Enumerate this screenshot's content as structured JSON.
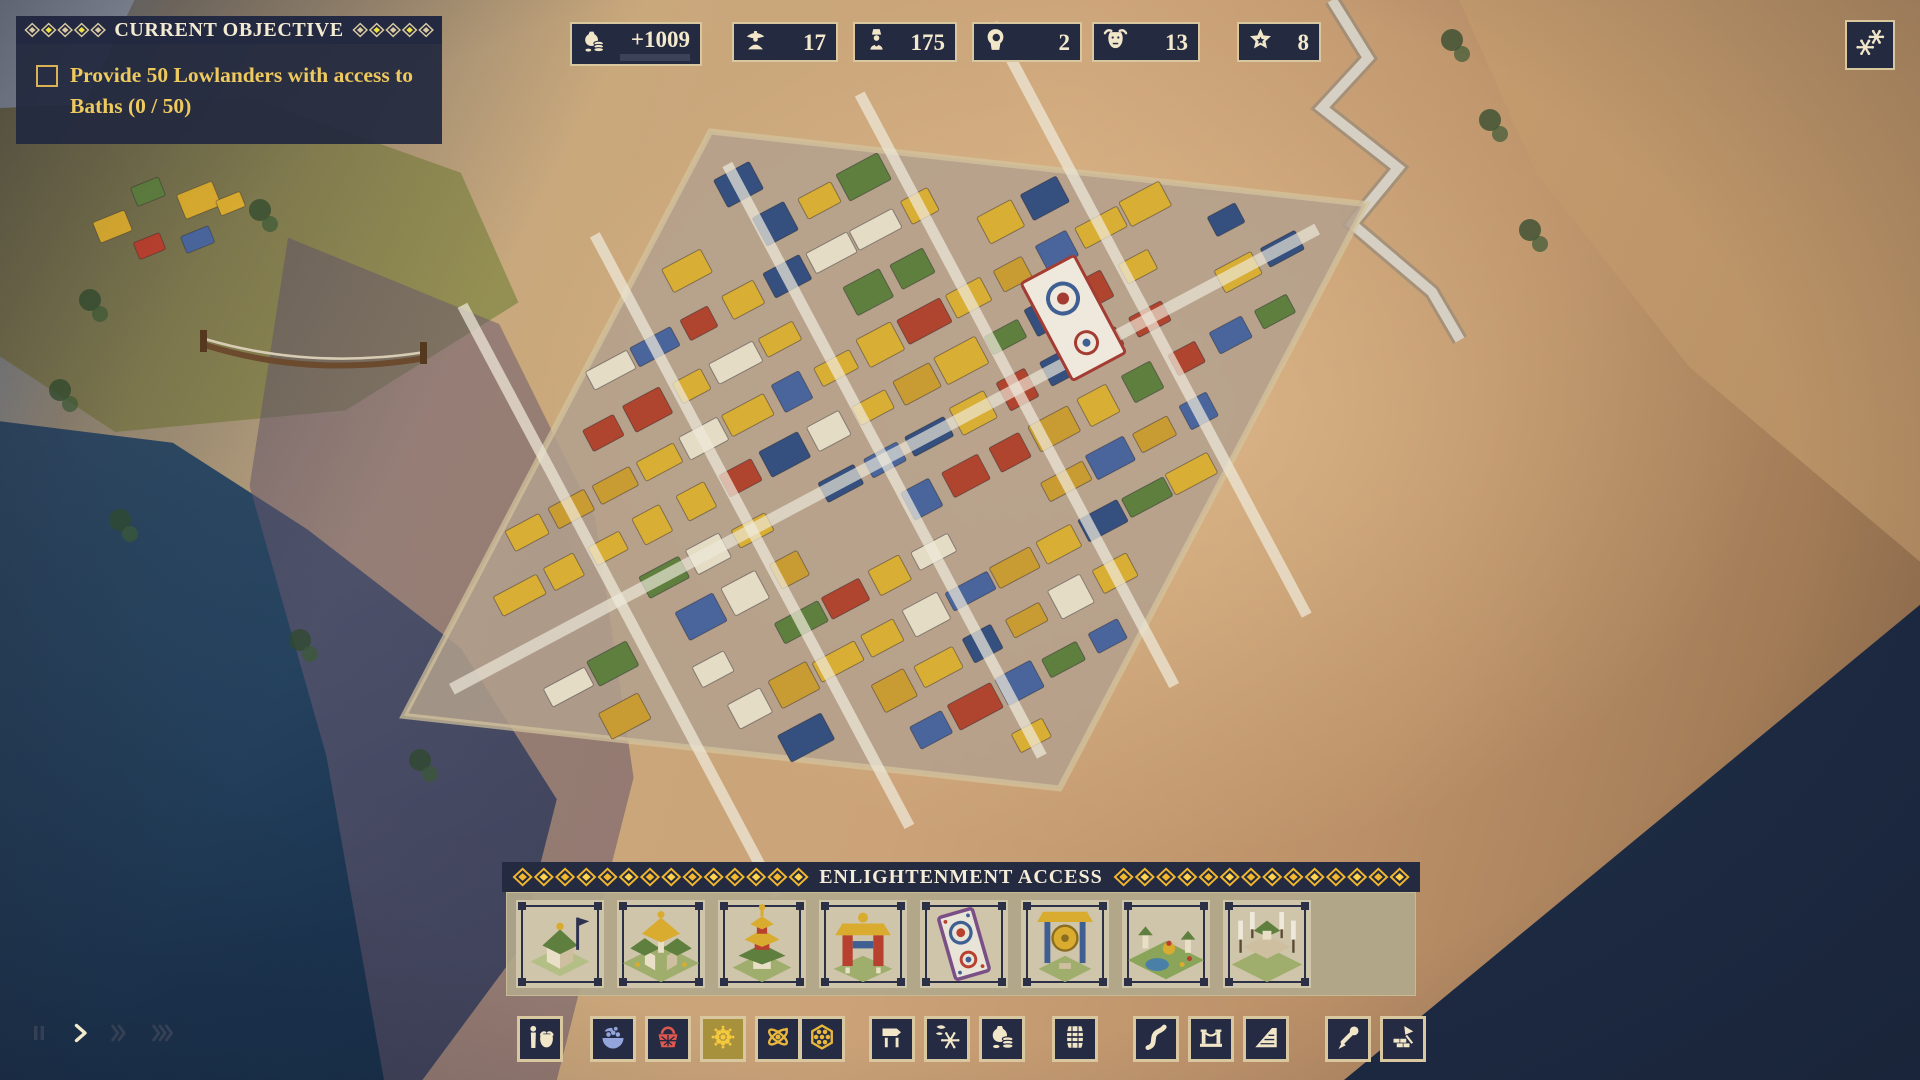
{
  "objective_panel": {
    "title": "CURRENT OBJECTIVE",
    "objectives": [
      {
        "text": "Provide 50 Lowlanders with access to Baths (0 / 50)",
        "completed": false
      }
    ]
  },
  "resource_bar": {
    "items": [
      {
        "icon": "coin-purse-icon",
        "value": "+1009",
        "progress_bar": true,
        "progress_percent": 100
      },
      {
        "icon": "straw-hat-worker-icon",
        "value": "17"
      },
      {
        "icon": "monk-icon",
        "value": "175"
      },
      {
        "icon": "hermit-icon",
        "value": "2"
      },
      {
        "icon": "yak-icon",
        "value": "13"
      },
      {
        "icon": "star-icon",
        "value": "8"
      }
    ]
  },
  "map_controls": {
    "snow_overlay_button": {
      "icon": "snowflakes-icon"
    }
  },
  "enlightenment_panel": {
    "title": "ENLIGHTENMENT ACCESS",
    "thumbnails": [
      {
        "name": "shrine"
      },
      {
        "name": "temple-complex"
      },
      {
        "name": "pagoda-temple"
      },
      {
        "name": "ceremonial-gate"
      },
      {
        "name": "sand-mandala"
      },
      {
        "name": "gong"
      },
      {
        "name": "garden-plaza"
      },
      {
        "name": "banner-platform"
      }
    ]
  },
  "build_toolbar": {
    "groups": [
      {
        "frames": [
          {
            "buttons": [
              {
                "icon": "villager-yak-icon",
                "color": "#f1e6c8",
                "selected": false
              }
            ]
          }
        ]
      },
      {
        "frames": [
          {
            "buttons": [
              {
                "icon": "forage-bowl-icon",
                "color": "#93a5dc",
                "selected": false
              }
            ]
          },
          {
            "buttons": [
              {
                "icon": "basket-icon",
                "color": "#e0574f",
                "selected": false
              }
            ]
          },
          {
            "buttons": [
              {
                "icon": "mandala-flower-icon",
                "color": "#f5c93e",
                "selected": true
              }
            ]
          },
          {
            "buttons": [
              {
                "icon": "atom-icon",
                "color": "#e9b73c",
                "selected": false
              },
              {
                "icon": "hex-cluster-icon",
                "color": "#e9b73c",
                "selected": false
              }
            ]
          }
        ]
      },
      {
        "frames": [
          {
            "buttons": [
              {
                "icon": "signpost-icon",
                "color": "#f1e6c8",
                "selected": false
              }
            ]
          },
          {
            "buttons": [
              {
                "icon": "snowflake-leaf-icon",
                "color": "#f1e6c8",
                "selected": false
              }
            ]
          },
          {
            "buttons": [
              {
                "icon": "coin-purse-icon",
                "color": "#f1e6c8",
                "selected": false
              }
            ]
          }
        ]
      },
      {
        "frames": [
          {
            "buttons": [
              {
                "icon": "barrel-icon",
                "color": "#f1e6c8",
                "selected": false
              }
            ]
          }
        ]
      },
      {
        "frames": [
          {
            "buttons": [
              {
                "icon": "road-icon",
                "color": "#f1e6c8",
                "selected": false
              }
            ]
          },
          {
            "buttons": [
              {
                "icon": "bridge-icon",
                "color": "#f1e6c8",
                "selected": false
              }
            ]
          },
          {
            "buttons": [
              {
                "icon": "ramp-icon",
                "color": "#f1e6c8",
                "selected": false
              }
            ]
          }
        ]
      },
      {
        "frames": [
          {
            "buttons": [
              {
                "icon": "eyedropper-icon",
                "color": "#f1e6c8",
                "selected": false
              }
            ]
          },
          {
            "buttons": [
              {
                "icon": "demolish-icon",
                "color": "#f1e6c8",
                "selected": false
              }
            ]
          }
        ]
      }
    ]
  },
  "speed_controls": {
    "buttons": [
      {
        "icon": "pause-icon",
        "active": false
      },
      {
        "icon": "play-icon",
        "active": true
      },
      {
        "icon": "fast-forward-icon",
        "active": false
      },
      {
        "icon": "fastest-forward-icon",
        "active": false
      }
    ]
  },
  "colors": {
    "panel_navy": "#242a40",
    "frame_tan": "#d9c7a0",
    "cream": "#f1e6c8",
    "objective_gold": "#eec95e",
    "pattern_yellow": "#f0e23e",
    "banner_gold": "#f2b72e",
    "selected_button_gold": "#a8913c",
    "speed_inactive": "#3a4458",
    "speed_active": "#f3eacb"
  }
}
